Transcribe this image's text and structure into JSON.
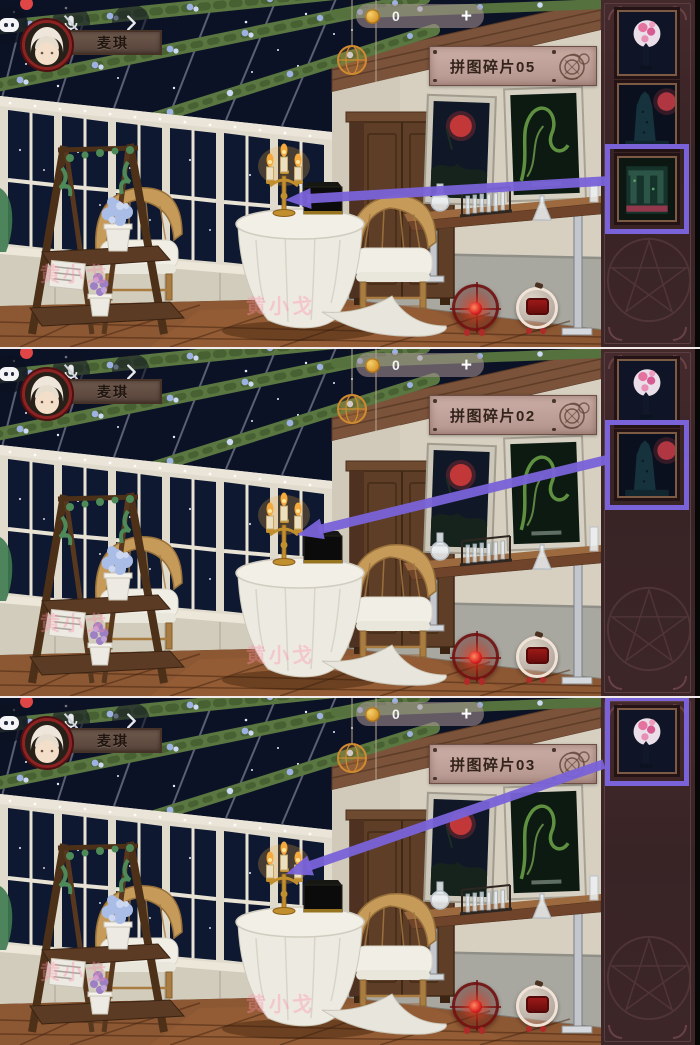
{
  "meta": {
    "accent_color": "#7a63d9",
    "sidebar_color": "#3c2628",
    "banner_color": "#c3a49c",
    "name_banner_color": "#655044"
  },
  "hud": {
    "player_name": "麦琪",
    "currency": {
      "value": "0",
      "add_label": "+",
      "icon": "gold-coin-icon"
    },
    "icons": {
      "chat": "chat-bubble-icon",
      "badge": "notification-dot",
      "mic": "mic-muted-icon",
      "expand": "chevron-right-icon"
    }
  },
  "bottom_icons": {
    "hint": "red-target-hint-icon",
    "message": "red-message-icon"
  },
  "watermark": "黄小戈",
  "panels": [
    {
      "label": "拼图碎片05",
      "slots": [
        {
          "image": "pink-moon-fragment",
          "highlighted": false
        },
        {
          "image": "dark-tower-fragment",
          "highlighted": false
        },
        {
          "image": "green-ruins-fragment",
          "highlighted": true
        }
      ],
      "arrow": {
        "x1": 606,
        "y1": 181,
        "x2": 285,
        "y2": 200
      }
    },
    {
      "label": "拼图碎片02",
      "slots": [
        {
          "image": "pink-moon-fragment",
          "highlighted": false
        },
        {
          "image": "dark-tower-fragment",
          "highlighted": true
        }
      ],
      "arrow": {
        "x1": 606,
        "y1": 111,
        "x2": 297,
        "y2": 186
      }
    },
    {
      "label": "拼图碎片03",
      "slots": [
        {
          "image": "pink-moon-fragment",
          "highlighted": true
        }
      ],
      "arrow": {
        "x1": 604,
        "y1": 66,
        "x2": 286,
        "y2": 176
      }
    }
  ]
}
